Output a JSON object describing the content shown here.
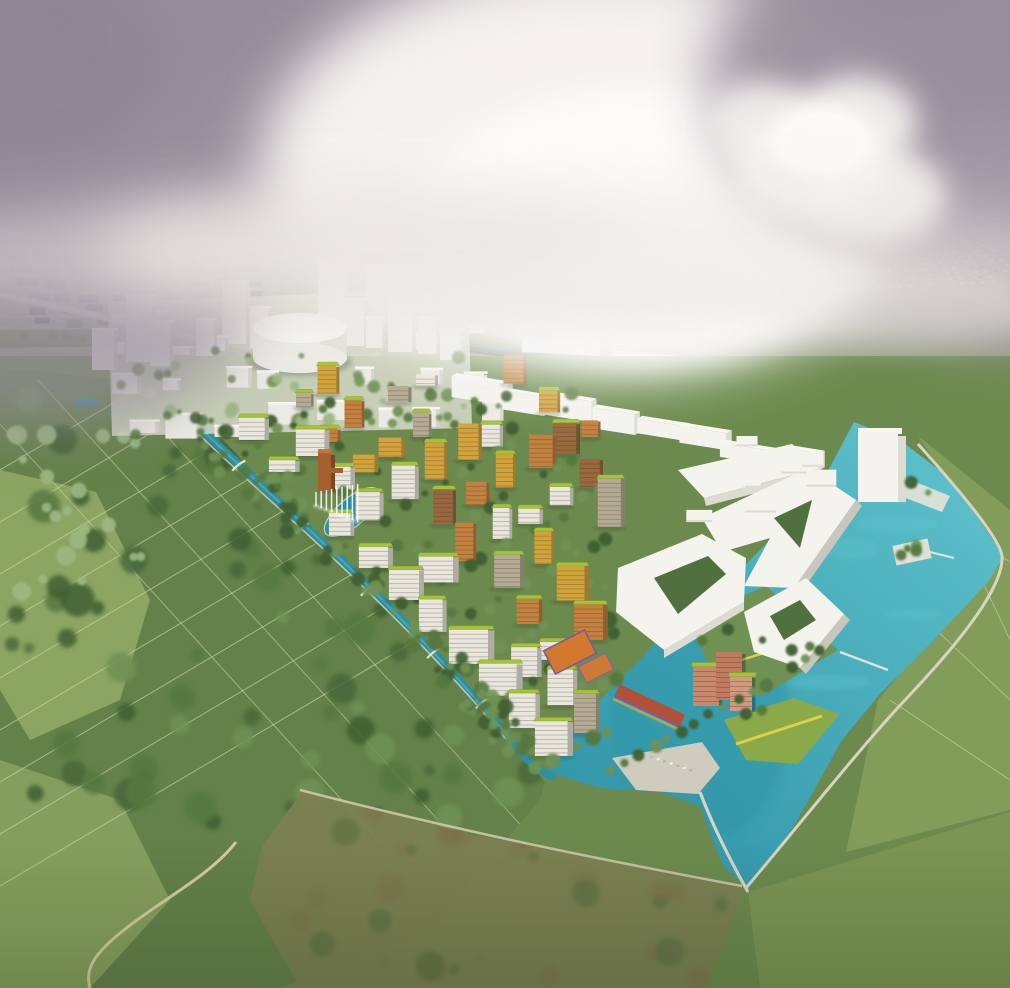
{
  "meta": {
    "description": "Aerial architectural rendering of a waterfront eco-district masterplan: rows of green-roofed mid-rise buildings in orange, ochre and white set among trees and canals, a white massing context city with a cylindrical arena, large angular white courtyard buildings beside a turquoise lake, surrounded by polder fields and marsh under a hazy cloudy sky.",
    "image": {
      "width": 1010,
      "height": 988
    }
  },
  "landmarks": [
    "cloudy-sky",
    "distant-city-horizon",
    "industrial-zone",
    "suburban-sprawl",
    "highway",
    "railway-corridor",
    "white-massing-city",
    "event-arena-cylinder",
    "green-roofed-residential-district",
    "canal-network",
    "fountain-basin",
    "corten-sculpture-tower",
    "sports-courts",
    "market-hall",
    "salmon-building",
    "waterfront-plaza",
    "pedestrian-bridges",
    "angular-white-courtyard-buildings",
    "white-tower",
    "turquoise-lake",
    "green-peninsula",
    "tree-island",
    "lawn-with-yellow-path",
    "woodland-parcels",
    "marsh-meadow",
    "sandy-paths"
  ],
  "palette": {
    "sky_top": "#aaa2ab",
    "sky_mid": "#cbc6ca",
    "sky_low": "#e7e4e1",
    "sky_bright": "#f9f7f4",
    "cloud_shadow": "#948c99",
    "cloud_white": "#f6f4f1",
    "haze": "#eae7e3",
    "distant_base": "#9aa089",
    "distant_tint": "#9a8fa0",
    "distant_industrial": "#5d6875",
    "distant_industrial_dark": "#424f5f",
    "suburb_white": "#eae7df",
    "suburb_dash_right": "#d6d2cb",
    "sports_green": "#3f7a3c",
    "greenbelt": "#75885b",
    "greenbelt_dark": "#5c7144",
    "rail_band": "#66705c",
    "rail_teal": "#3f98a6",
    "rail_dark": "#4a5244",
    "parking_base": "#b2afa2",
    "parking_dash": "#7d7a71",
    "road_light": "#c9c6ba",
    "road_line": "#ece9de",
    "field_green": "#6c8a4e",
    "woodland_overlay": "#5a7844",
    "woodland_dark": "#49673a",
    "meadow_light": "#93ac66",
    "marsh_olive": "#7d8052",
    "marsh_brown": "#7f7049",
    "sand": "#cbbb90",
    "sand_path": "#d6caa0",
    "parcel_line": "#ccd2a8",
    "path_light": "#d8d4c2",
    "dike_path": "#cfc6a8",
    "right_fields": "#85a05c",
    "right_fields_south": "#7d9655",
    "water_light": "#5fc2cc",
    "water_deep": "#2e93a6",
    "canal": "#2f8fa0",
    "quay": "#e6e3d6",
    "plaza": "#cfcbbd",
    "massing_top": "#f7f6f2",
    "massing_front": "#eceae4",
    "massing_side": "#d8d5cd",
    "plinth": "#d7d9c9",
    "site_green": "#5f7f46",
    "tree_dark": "#3f5e33",
    "tree_mid": "#567840",
    "tree_light": "#6f9254",
    "tree_pale": "#9db884",
    "roof_lime": "#a6c23a",
    "roof_lime_dark": "#86a22c",
    "bldg_white": "#e9e6dd",
    "bldg_ochre": "#d2a33c",
    "bldg_orange": "#c2813f",
    "bldg_brown": "#99683f",
    "bldg_beige": "#b5aa93",
    "bldg_salmon_1": "#c9896e",
    "bldg_salmon_2": "#c07a60",
    "bldg_salmon_3": "#d09a7e",
    "court_orange": "#d2782f",
    "court_orange_2": "#cf7a35",
    "court_purple": "#7b55a6",
    "court_purple_2": "#8a5fae",
    "corten": "#a5602f",
    "corten_dark": "#7d4722",
    "corten_light": "#c0763c",
    "market_roof": "#b25038",
    "market_purple": "#8058a8",
    "market_green": "#93b05c",
    "lawn": "#8aaa49",
    "lawn_path": "#ddd04b",
    "white_arch": "#f4f3ee",
    "white_arch_shade": "#dedbd2",
    "white_arch_dark": "#c9c6bc",
    "court_green": "#50703f",
    "car_white": "#f2f2f0",
    "car_gray": "#aeb2b6"
  },
  "render_config": {
    "seed": 11,
    "building_rows": 11,
    "lime_roof_ratio": 0.65
  }
}
